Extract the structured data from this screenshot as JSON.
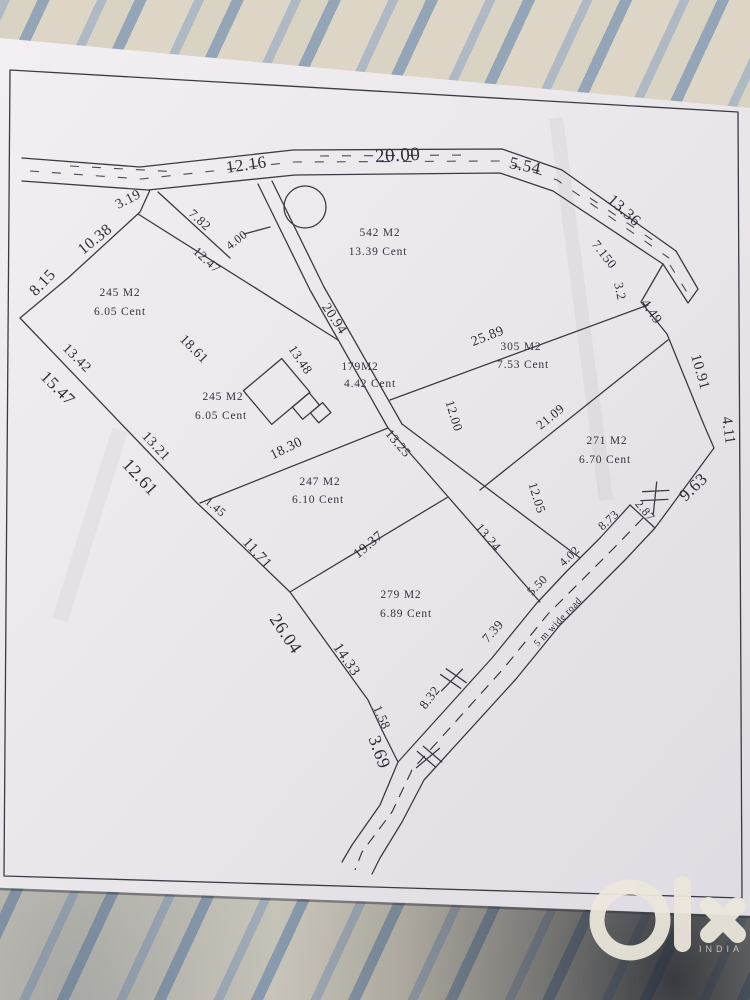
{
  "drawing": {
    "dims": [
      "12.16",
      "20.00",
      "5.54",
      "13.36",
      "7.150",
      "3.2",
      "4.49",
      "10.91",
      "4.11",
      "9.63",
      "3.19",
      "10.38",
      "8.15",
      "13.42",
      "15.47",
      "13.21",
      "12.61",
      "1.45",
      "11.71",
      "26.04",
      "14.33",
      "1.58",
      "3.69",
      "7.82",
      "4.00",
      "12.47",
      "18.61",
      "20.94",
      "13.48",
      "18.30",
      "12.00",
      "13.25",
      "12.05",
      "13.24",
      "19.37",
      "21.09",
      "25.89",
      "8.73",
      "2.87",
      "4.02",
      "5.50",
      "7.39",
      "8.32"
    ],
    "road_label": "5 m wide road",
    "plots": [
      {
        "area": "542 M2",
        "cent": "13.39 Cent"
      },
      {
        "area": "245 M2",
        "cent": "6.05 Cent"
      },
      {
        "area": "305 M2",
        "cent": "7.53 Cent"
      },
      {
        "area": "245 M2",
        "cent": "6.05 Cent"
      },
      {
        "area": "179M2",
        "cent": "4.42 Cent"
      },
      {
        "area": "271 M2",
        "cent": "6.70 Cent"
      },
      {
        "area": "247 M2",
        "cent": "6.10 Cent"
      },
      {
        "area": "279 M2",
        "cent": "6.89 Cent"
      }
    ],
    "symbols": {
      "well": "circle",
      "building": "building-footprint",
      "crossing": "hatch-marks"
    }
  },
  "watermark": {
    "brand": "olx",
    "country": "INDIA"
  }
}
